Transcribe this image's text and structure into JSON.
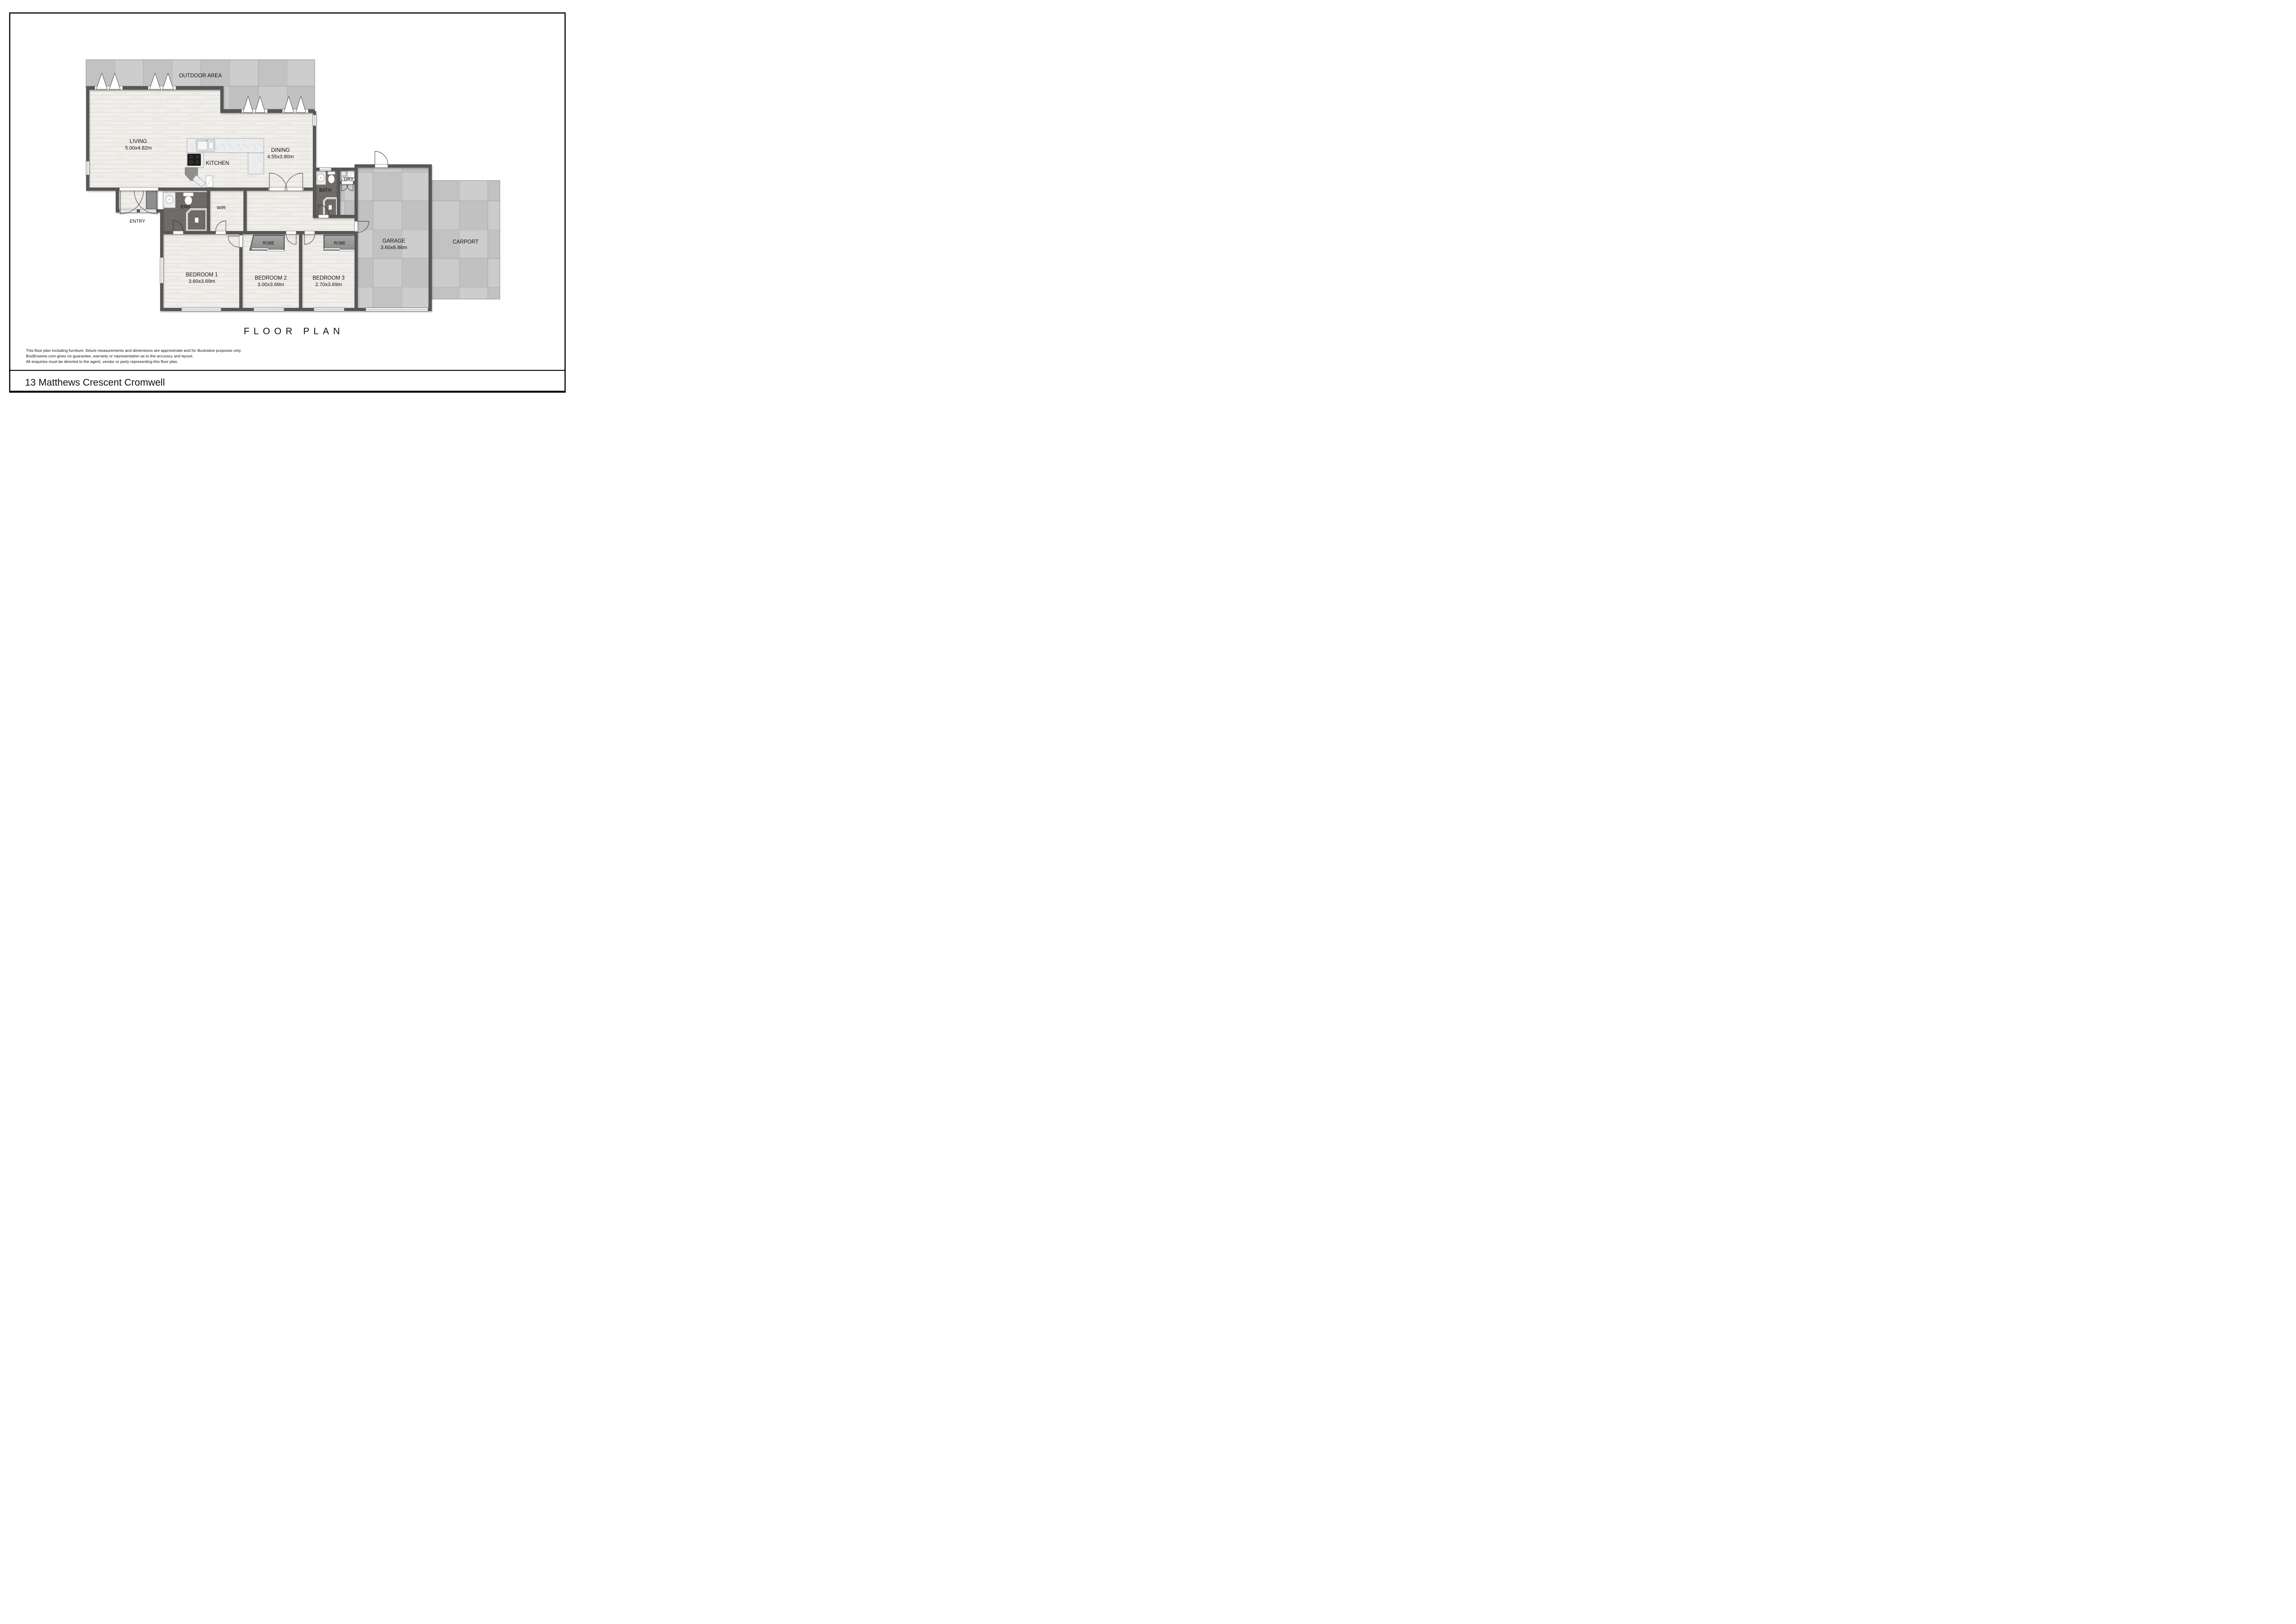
{
  "page": {
    "floor_plan_title": "FLOOR PLAN",
    "address": "13 Matthews Crescent Cromwell",
    "disclaimer": [
      "This floor plan including furniture, fixture measurements and dimensions are approximate and for illustrative purposes only.",
      "BoxBrownie.com gives no guarantee, warranty or representation as to the accuracy and layout.",
      "All enquiries must be directed to the agent, vendor or party representing this floor plan."
    ]
  },
  "rooms": {
    "outdoor": {
      "label": "OUTDOOR AREA"
    },
    "living": {
      "label": "LIVING",
      "dims": "5.00x4.82m"
    },
    "kitchen": {
      "label": "KITCHEN"
    },
    "dining": {
      "label": "DINING",
      "dims": "4.55x3.80m"
    },
    "bath": {
      "label": "BATH"
    },
    "laundry": {
      "label": "L’DRY"
    },
    "ens": {
      "label": "ENS"
    },
    "wir": {
      "label": "WIR"
    },
    "entry": {
      "label": "ENTRY"
    },
    "robe1": {
      "label": "ROBE"
    },
    "robe2": {
      "label": "ROBE"
    },
    "bedroom1": {
      "label": "BEDROOM 1",
      "dims": "3.60x3.69m"
    },
    "bedroom2": {
      "label": "BEDROOM 2",
      "dims": "3.00x3.69m"
    },
    "bedroom3": {
      "label": "BEDROOM 3",
      "dims": "2.70x3.69m"
    },
    "garage": {
      "label": "GARAGE",
      "dims": "3.60x6.86m"
    },
    "carport": {
      "label": "CARPORT"
    }
  },
  "colors": {
    "wall": "#575757",
    "wood_floor": "#f1efeb",
    "concrete": "#c8c8c8",
    "dark_tile": "#6e6a67",
    "marble": "#ecedef",
    "robe_fill": "#9a9a9a"
  }
}
